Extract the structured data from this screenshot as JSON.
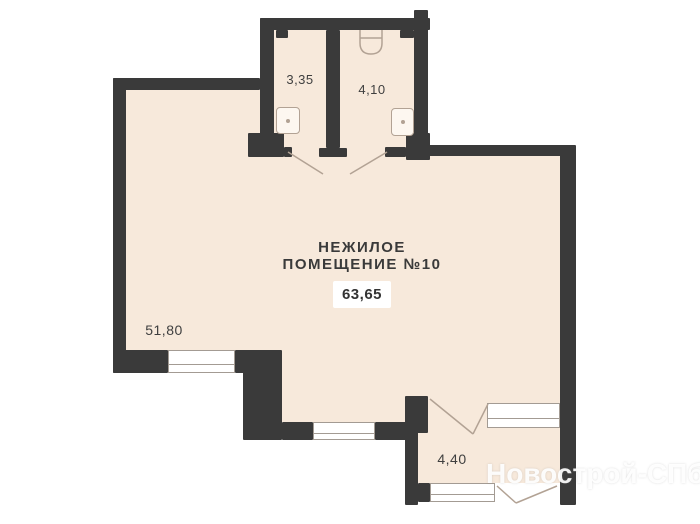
{
  "plan": {
    "title": {
      "line1": "НЕЖИЛОЕ",
      "line2": "ПОМЕЩЕНИЕ №10"
    },
    "total_area": "63,65",
    "rooms": [
      {
        "name": "wet-room-left",
        "area": "3,35"
      },
      {
        "name": "wet-room-right",
        "area": "4,10"
      },
      {
        "name": "main-hall",
        "area": "51,80"
      },
      {
        "name": "vestibule",
        "area": "4,40"
      }
    ],
    "watermark": "Новострой-СПб",
    "colors": {
      "wall": "#3a3a3a",
      "floor": "#f7e9db",
      "fixture_line": "#b2a294",
      "background": "#ffffff"
    }
  }
}
